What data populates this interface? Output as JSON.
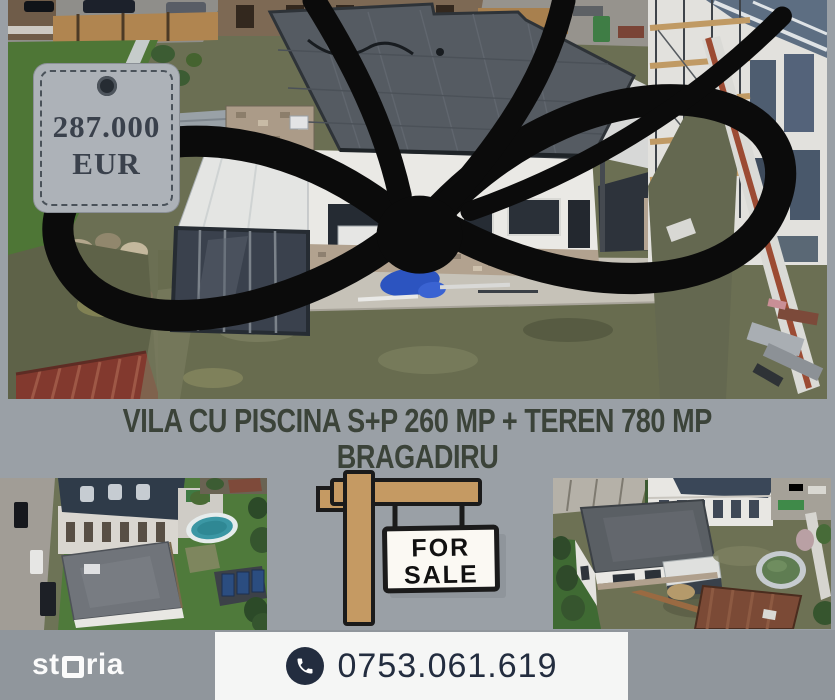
{
  "page": {
    "width": 835,
    "height": 700,
    "background": "#9aa0a6"
  },
  "price_tag": {
    "price": "287.000",
    "currency": "EUR",
    "tag_fill": "#adb2b8",
    "text_color": "#3a414c",
    "ribbon_color": "#0b0b0b"
  },
  "title": {
    "line1": "VILA CU PISCINA S+P 260 MP + TEREN 780 MP",
    "line2": "BRAGADIRU",
    "color": "#3b4339"
  },
  "for_sale_sign": {
    "word1": "FOR",
    "word2": "SALE",
    "wood_color": "#c59a63",
    "board_color": "#fbf9f3",
    "outline_color": "#1b1b1b"
  },
  "footer": {
    "brand": "storia",
    "brand_left": "st",
    "brand_right": "ria",
    "phone": "0753.061.619",
    "panel_color": "#f5f6f5",
    "phone_color": "#232d3f",
    "bar_color": "#90969c"
  },
  "photos": {
    "main": "aerial-view-villa-flat-roof-under-construction",
    "bottom_left": "aerial-view-villa-street-and-pool",
    "bottom_right": "aerial-view-villa-yard-and-pool"
  }
}
